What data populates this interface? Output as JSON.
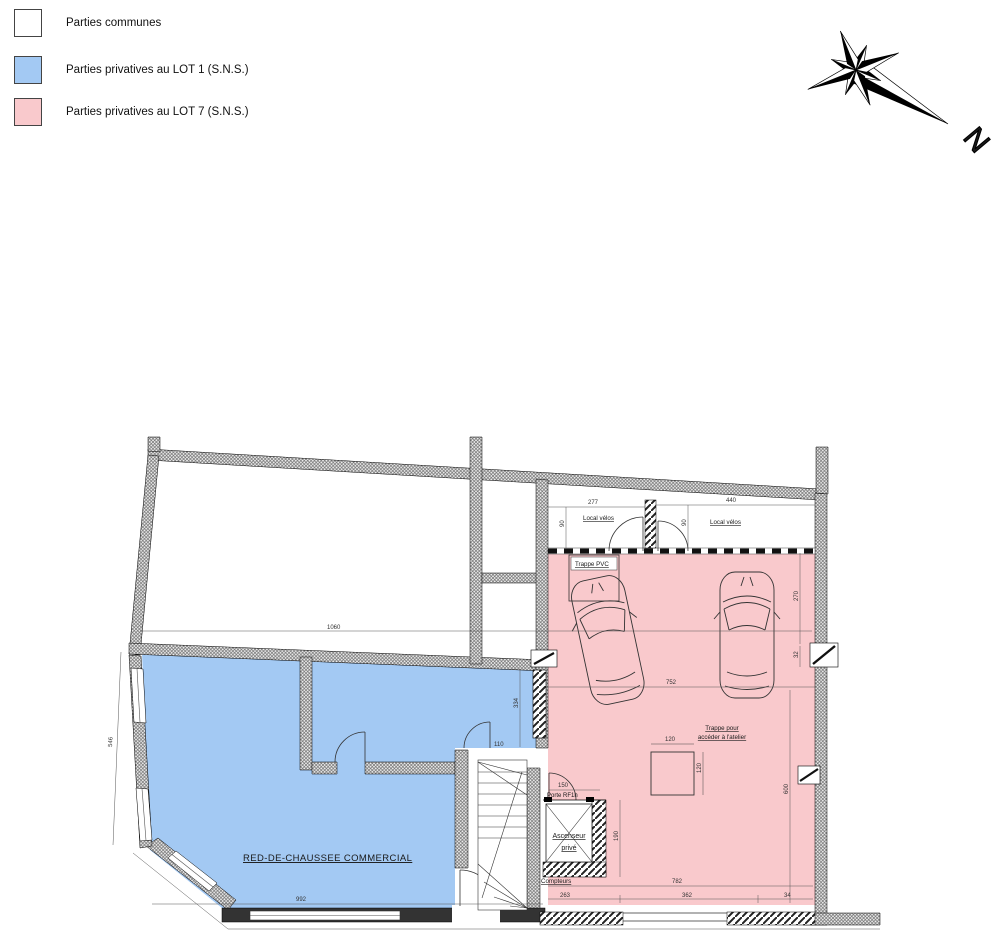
{
  "legend": {
    "items": [
      {
        "label": "Parties communes",
        "color": "#ffffff"
      },
      {
        "label": "Parties privatives au LOT 1 (S.N.S.)",
        "color": "#a3c9f3"
      },
      {
        "label": "Parties privatives au LOT 7 (S.N.S.)",
        "color": "#f9c9cc"
      }
    ]
  },
  "compass": {
    "north_label": "N"
  },
  "plan": {
    "labels": {
      "commercial": "RED-DE-CHAUSSEE COMMERCIAL",
      "bike_room_left": "Local vélos",
      "bike_room_right": "Local vélos",
      "trappe_pvc": "Trappe PVC",
      "trappe_atelier_line1": "Trappe pour",
      "trappe_atelier_line2": "accéder à l'atelier",
      "elevator_line1": "Ascenseur",
      "elevator_line2": "privé",
      "fire_door": "Porte RF1h",
      "meters": "Compteurs"
    },
    "dimensions": {
      "top_room_width": "1060",
      "storefront_left": "546",
      "commercial_width": "992",
      "bike_left_width": "277",
      "bike_right_width": "440",
      "bike_left_depth": "90",
      "bike_right_depth": "90",
      "garage_width": "752",
      "right_upper": "270",
      "right_window": "32",
      "right_lower": "600",
      "hatch_width": "120",
      "hatch_height": "120",
      "mid_wall": "334",
      "door_clear": "110",
      "fire_door_width": "150",
      "elevator_depth": "190",
      "bottom_a": "263",
      "bottom_b": "362",
      "bottom_c": "34",
      "bottom_total": "782"
    }
  },
  "colors": {
    "lot1_fill": "#a3c9f3",
    "lot7_fill": "#f9c9cc",
    "wall_hatch": "#707070"
  }
}
